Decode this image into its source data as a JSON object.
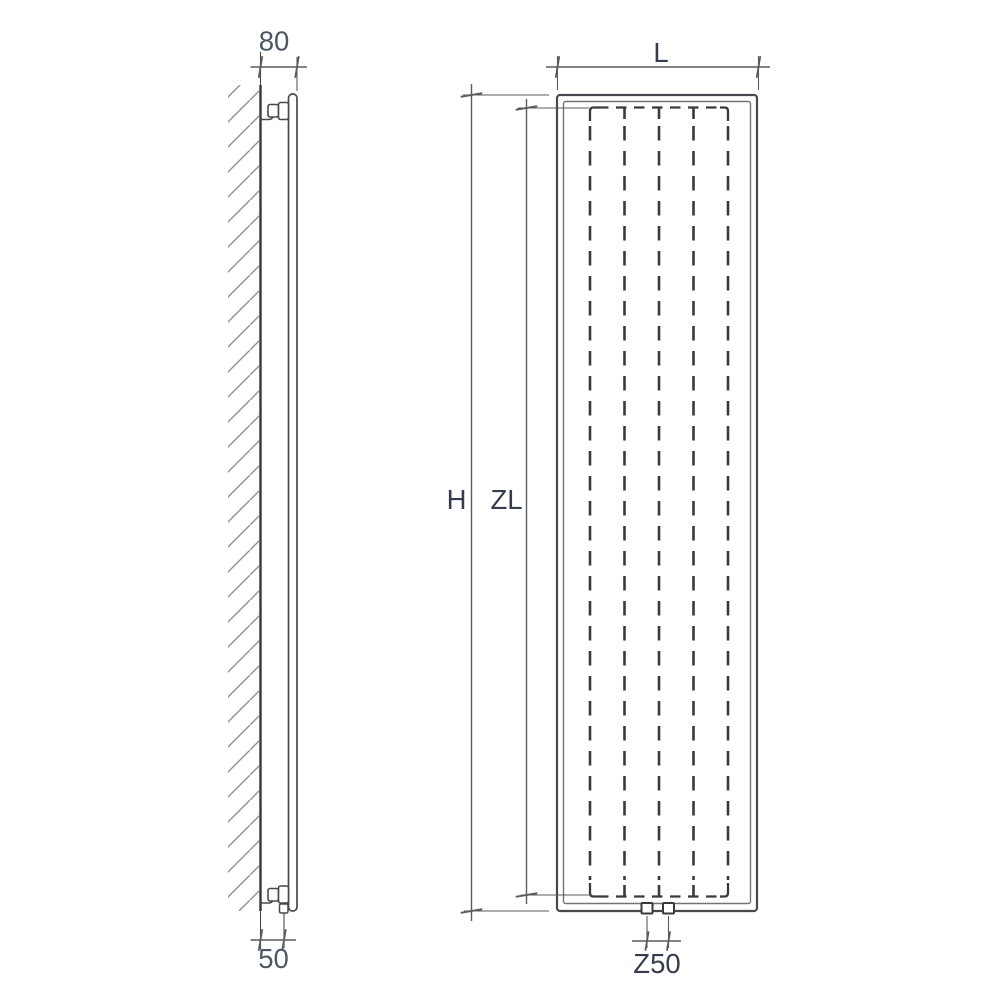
{
  "diagram": {
    "type": "radiator-technical-drawing",
    "views": {
      "side": "side-profile-on-wall",
      "front": "front-elevation"
    }
  },
  "colors": {
    "background": "#ffffff",
    "line": "#46494e",
    "wall": "#34373c",
    "dash": "#383a3f",
    "dim_line": "#585b61",
    "hatch": "#8f9296",
    "label_primary": "#363d4e",
    "label_secondary": "#4d5761"
  },
  "side_view": {
    "wall_offset_label": "80",
    "pipe_offset_label": "50"
  },
  "front_view": {
    "width_label": "L",
    "height_label": "H",
    "element_height_label": "ZL",
    "connection_spacing_label": "Z50"
  }
}
